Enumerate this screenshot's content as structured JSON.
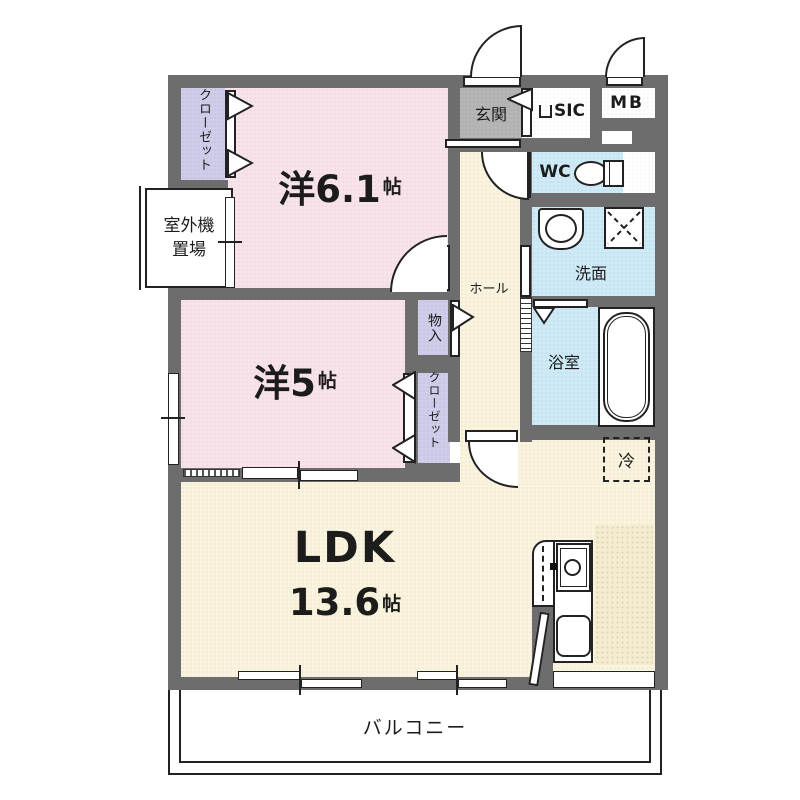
{
  "plan_type": "apartment-floorplan",
  "rooms": {
    "bedroom1": {
      "prefix": "洋",
      "size": "6.1",
      "unit": "帖"
    },
    "bedroom2": {
      "prefix": "洋",
      "size": "5",
      "unit": "帖"
    },
    "ldk": {
      "name": "LDK",
      "size": "13.6",
      "unit": "帖"
    },
    "hall": {
      "label": "ホール"
    },
    "entrance": {
      "label": "玄関"
    },
    "sic": {
      "label": "SIC"
    },
    "mb": {
      "label": "MB"
    },
    "wc": {
      "label": "WC"
    },
    "washroom": {
      "label": "洗面"
    },
    "bathroom": {
      "label": "浴室"
    },
    "closet1": {
      "label": "クローゼット"
    },
    "closet2": {
      "label": "クローゼット"
    },
    "storage": {
      "label": "物入"
    },
    "outdoor_unit": {
      "line1": "室外機",
      "line2": "置場"
    },
    "fridge": {
      "label": "冷"
    },
    "balcony": {
      "label": "バルコニー"
    }
  },
  "colors": {
    "wall": "#6d6d6d",
    "bedroom_pink": "#f9e3eb",
    "closet_lavender": "#cfcdea",
    "living_cream": "#faf3dd",
    "wet_blue": "#cdeaf6",
    "entrance_gray": "#b5b5b5",
    "line": "#222222"
  }
}
